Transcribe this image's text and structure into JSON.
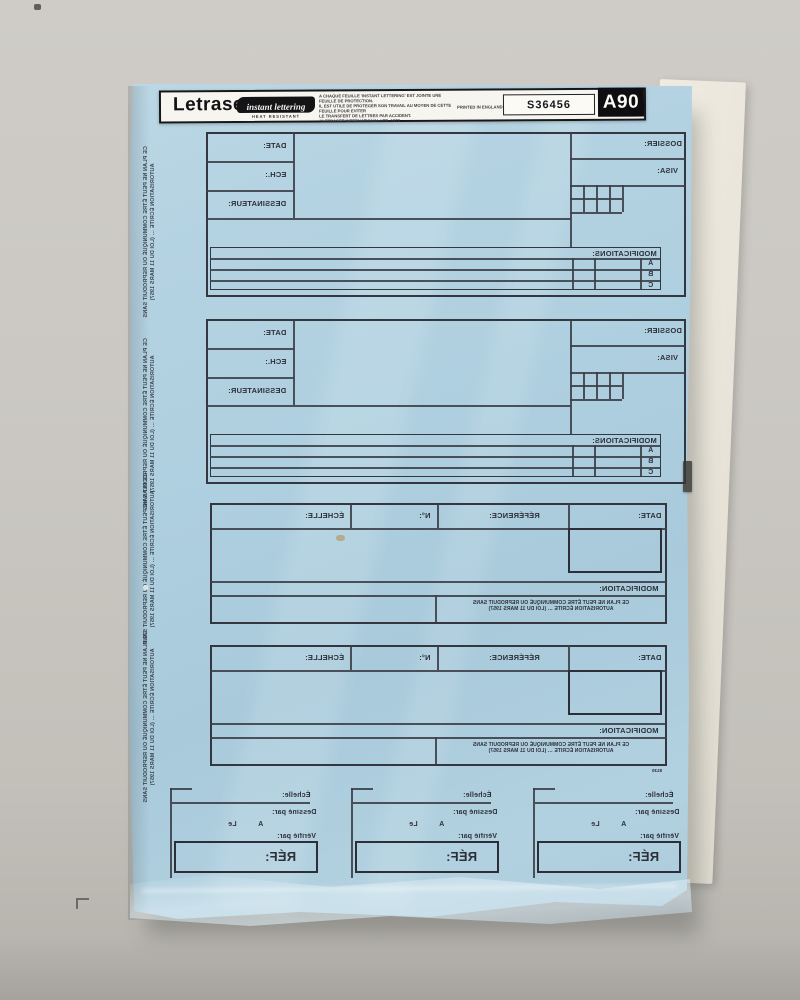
{
  "colors": {
    "backdrop": "#cac7c1",
    "sheet_blue": "#b4d1df",
    "backing_paper": "#eae6db",
    "ink": "#2e313a",
    "header_bg": "#f7f5f0"
  },
  "header": {
    "brand": "Letraset",
    "tagline": "instant lettering",
    "subtagline": "HEAT RESISTANT",
    "notice_lines": [
      "A CHAQUE FEUILLE 'INSTANT LETTERING' EST JOINTE UNE FEUILLE DE PROTECTION.",
      "IL EST UTILE DE PROTEGER SON TRAVAIL AU MOYEN DE CETTE FEUILLE POUR EVITER",
      "LE TRANSFERT DE LETTRES PAR ACCIDENT.",
      "©LETRASET INTERNATIONAL LTD. 1973"
    ],
    "printed": "PRINTED IN ENGLAND",
    "code": "S36456",
    "sheet_id": "A90"
  },
  "legal_note": {
    "line1": "CE PLAN NE PEUT ÊTRE COMMUNIQUÉ OU REPRODUIT SANS",
    "line2": "AUTORISATION ÉCRITE … (LOI DU 11 MARS 1957)"
  },
  "title_block": {
    "date": "DATE:",
    "ech": "ECH.:",
    "dessinateur": "DESSINATEUR:",
    "dossier": "DOSSIER:",
    "visa": "VISA:",
    "modifications": "MODIFICATIONS:",
    "row_a": "A",
    "row_b": "B",
    "row_c": "C"
  },
  "ref_title_block": {
    "date": "DATE:",
    "reference": "RÉFÉRENCE:",
    "numero": "N°:",
    "echelle": "ÉCHELLE:",
    "modification": "MODIFICATION:"
  },
  "bottom_block": {
    "echelle": "Échelle:",
    "dessine_par": "Dessiné par:",
    "a": "A",
    "le": "Le",
    "verifie_par": "Vérifié par:",
    "ref": "RÉF:"
  },
  "corner_code": "8130"
}
